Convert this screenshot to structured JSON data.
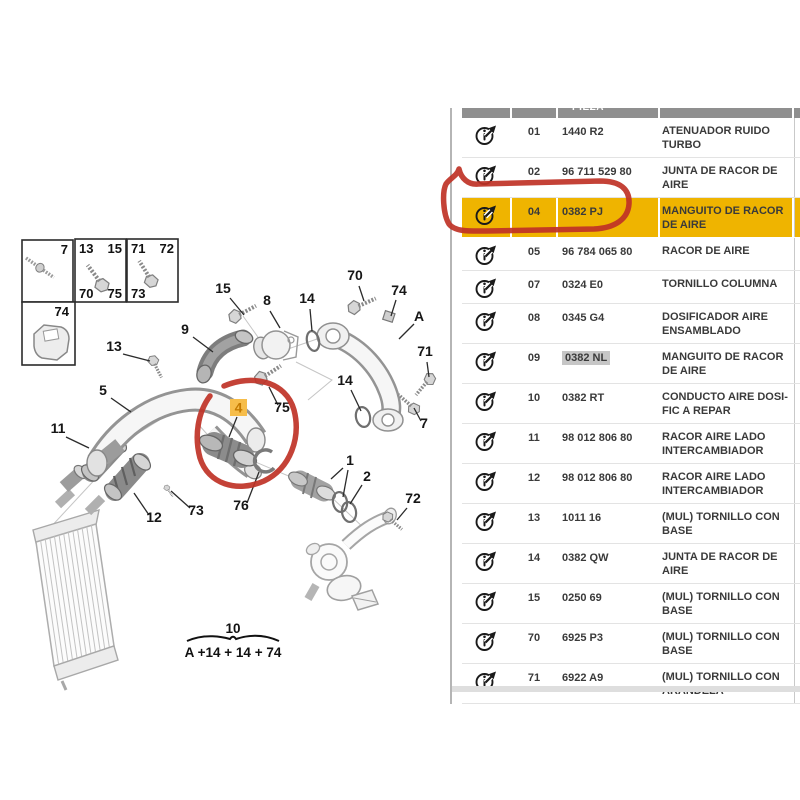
{
  "colors": {
    "row_highlight": "#efb400",
    "selected_code_bg": "#c6c6c6",
    "annotation_red": "#bf3226",
    "part_label_bg": "#f6bd4a",
    "part_label_fg": "#c47a00"
  },
  "icons": {
    "row_icon": "info-arrow-icon"
  },
  "table": {
    "header_fragment": "PIEZA",
    "rows": [
      {
        "num": "01",
        "code": "1440 R2",
        "desc": "ATENUADOR RUIDO TURBO"
      },
      {
        "num": "02",
        "code": "96 711 529 80",
        "desc": "JUNTA DE RACOR DE AIRE"
      },
      {
        "num": "04",
        "code": "0382 PJ",
        "desc": "MANGUITO DE RACOR DE AIRE",
        "highlight": true
      },
      {
        "num": "05",
        "code": "96 784 065 80",
        "desc": "RACOR DE AIRE"
      },
      {
        "num": "07",
        "code": "0324 E0",
        "desc": "TORNILLO COLUMNA"
      },
      {
        "num": "08",
        "code": "0345 G4",
        "desc": "DOSIFICADOR AIRE ENSAMBLADO"
      },
      {
        "num": "09",
        "code": "0382 NL",
        "desc": "MANGUITO DE RACOR DE AIRE",
        "code_selected": true
      },
      {
        "num": "10",
        "code": "0382 RT",
        "desc": "CONDUCTO AIRE DOSI-FIC A REPAR"
      },
      {
        "num": "11",
        "code": "98 012 806 80",
        "desc": "RACOR AIRE LADO INTERCAMBIADOR"
      },
      {
        "num": "12",
        "code": "98 012 806 80",
        "desc": "RACOR AIRE LADO INTERCAMBIADOR"
      },
      {
        "num": "13",
        "code": "1011 16",
        "desc": "(MUL) TORNILLO CON BASE"
      },
      {
        "num": "14",
        "code": "0382 QW",
        "desc": "JUNTA DE RACOR DE AIRE"
      },
      {
        "num": "15",
        "code": "0250 69",
        "desc": "(MUL) TORNILLO CON BASE"
      },
      {
        "num": "70",
        "code": "6925 P3",
        "desc": "(MUL) TORNILLO CON BASE"
      },
      {
        "num": "71",
        "code": "6922 A9",
        "desc": "(MUL) TORNILLO CON ARANDELA"
      }
    ]
  },
  "diagram": {
    "legend": {
      "b1": "7",
      "b2tl": "13",
      "b2tr": "15",
      "b2bl": "70",
      "b2br": "75",
      "b3tl": "71",
      "b3tr": "72",
      "b3bl": "73",
      "b4": "74"
    },
    "part4_label": "4",
    "formula": {
      "top": "10",
      "bottom": "A +14 + 14 + 74"
    },
    "labels": [
      {
        "t": "15",
        "x": 223,
        "y": 293,
        "lines": [
          [
            230,
            298,
            244,
            315
          ]
        ]
      },
      {
        "t": "8",
        "x": 267,
        "y": 305,
        "lines": [
          [
            270,
            311,
            280,
            328
          ]
        ]
      },
      {
        "t": "14",
        "x": 307,
        "y": 303,
        "lines": [
          [
            310,
            309,
            312,
            331
          ]
        ]
      },
      {
        "t": "70",
        "x": 355,
        "y": 280,
        "lines": [
          [
            359,
            286,
            364,
            301
          ]
        ]
      },
      {
        "t": "74",
        "x": 399,
        "y": 295,
        "lines": [
          [
            396,
            300,
            391,
            316
          ]
        ]
      },
      {
        "t": "A",
        "x": 419,
        "y": 321,
        "lines": [
          [
            414,
            324,
            399,
            339
          ]
        ]
      },
      {
        "t": "9",
        "x": 185,
        "y": 334,
        "lines": [
          [
            193,
            337,
            213,
            352
          ]
        ]
      },
      {
        "t": "13",
        "x": 114,
        "y": 351,
        "lines": [
          [
            123,
            354,
            150,
            361
          ]
        ]
      },
      {
        "t": "71",
        "x": 425,
        "y": 356,
        "lines": [
          [
            427,
            362,
            429,
            377
          ]
        ]
      },
      {
        "t": "5",
        "x": 103,
        "y": 395,
        "lines": [
          [
            111,
            398,
            131,
            412
          ]
        ]
      },
      {
        "t": "75",
        "x": 282,
        "y": 412,
        "lines": [
          [
            278,
            405,
            269,
            387
          ]
        ]
      },
      {
        "t": "14",
        "x": 345,
        "y": 385,
        "lines": [
          [
            351,
            390,
            361,
            411
          ]
        ]
      },
      {
        "t": "7",
        "x": 424,
        "y": 428,
        "lines": [
          [
            421,
            421,
            414,
            408
          ]
        ]
      },
      {
        "t": "11",
        "x": 58,
        "y": 433,
        "lines": [
          [
            66,
            437,
            89,
            448
          ]
        ]
      },
      {
        "t": "12",
        "x": 154,
        "y": 522,
        "lines": [
          [
            149,
            515,
            134,
            493
          ]
        ]
      },
      {
        "t": "73",
        "x": 196,
        "y": 515,
        "lines": [
          [
            190,
            508,
            171,
            491
          ]
        ]
      },
      {
        "t": "76",
        "x": 241,
        "y": 510,
        "lines": [
          [
            247,
            503,
            259,
            472
          ]
        ]
      },
      {
        "t": "1",
        "x": 350,
        "y": 465,
        "lines": [
          [
            343,
            468,
            331,
            479
          ],
          [
            348,
            470,
            343,
            497
          ]
        ]
      },
      {
        "t": "2",
        "x": 367,
        "y": 481,
        "lines": [
          [
            362,
            485,
            350,
            504
          ]
        ]
      },
      {
        "t": "72",
        "x": 413,
        "y": 503,
        "lines": [
          [
            407,
            508,
            397,
            520
          ]
        ]
      }
    ]
  }
}
